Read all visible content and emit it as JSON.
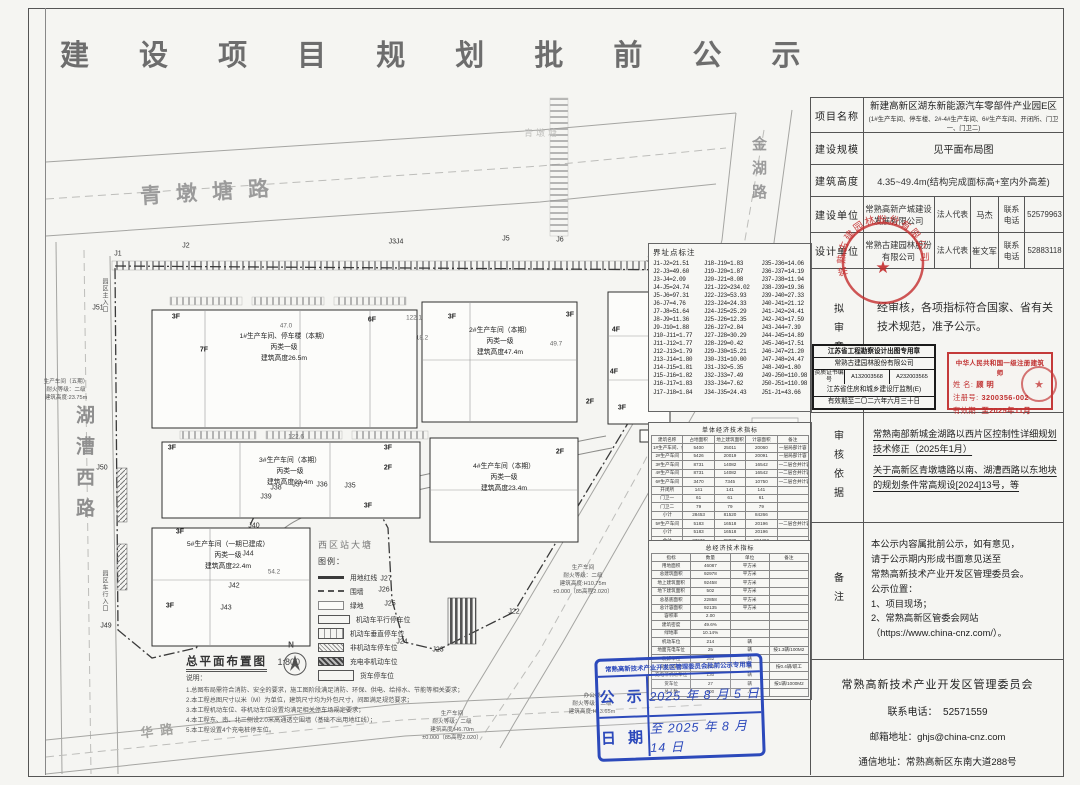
{
  "title": "建 设 项 目 规 划 批 前 公 示",
  "info": {
    "project_label": "项目名称",
    "project_name": "新建高新区湖东新能源汽车零部件产业园E区",
    "project_sub": "(1#生产车间、停车楼、2#-4#生产车间、6#生产车间、开闭所、门卫一、门卫二)",
    "scale_label": "建设规模",
    "scale_value": "见平面布局图",
    "height_label": "建筑高度",
    "height_value": "4.35~49.4m(结构完成面标高+室内外高差)",
    "builder_label": "建设单位",
    "builder_name": "常熟高新产城建设发展有限公司",
    "rep_label": "法人代表",
    "builder_rep": "马杰",
    "tel_label": "联系电话",
    "builder_tel": "52579963",
    "designer_label": "设计单位",
    "designer_name": "常熟古建园林股份有限公司",
    "designer_rep": "崔文军",
    "designer_tel": "52883118",
    "review_label": "拟审意见",
    "review_text": "经审核，各项指标符合国家、省有关技术规范，准予公示。",
    "basis_label": "审核依据",
    "basis_items": [
      "常熟南部新城金湖路以西片区控制性详细规划技术修正（2025年1月）",
      "关于高新区青墩塘路以南、湖漕西路以东地块的规划条件常高规设[2024]13号，等"
    ],
    "note_label": "备注",
    "note_lines": [
      "本公示内容属批前公示，如有意见，",
      "请于公示期内形成书面意见送至",
      "常熟高新技术产业开发区管理委员会。",
      "公示位置：",
      "1、项目现场；",
      "2、常熟高新区管委会网站",
      "（https://www.china-cnz.com/）。"
    ],
    "footer_org": "常熟高新技术产业开发区管理委员会",
    "footer_tel_label": "联系电话：",
    "footer_tel": "52571559",
    "footer_email_label": "邮箱地址：",
    "footer_email": "ghjs@china-cnz.com",
    "footer_addr_label": "通信地址：",
    "footer_addr": "常熟高新区东南大道288号"
  },
  "stamps": {
    "design_seal_text": "常熟古建园林股份有限公司",
    "design_seal_star": "★",
    "black_stamp": {
      "l1": "江苏省工程勘察设计出图专用章",
      "l2": "常熟古建园林股份有限公司",
      "cert_label": "资质证书编号",
      "cert1": "A132003568",
      "cert2": "A232003565",
      "l4": "江苏省住房和城乡建设厅监制(E)",
      "l5": "有效期至二〇二六年六月三十日"
    },
    "architect_stamp": {
      "title": "中华人民共和国一级注册建筑师",
      "name_label": "姓  名:",
      "name": "顾    明",
      "reg_label": "注册号:",
      "reg": "3200356-002",
      "valid_label": "有效期:",
      "valid": "至2025年11月",
      "seal_star": "★"
    },
    "blue_stamp": {
      "header": "常熟高新技术产业开发区管理委员会批前公示专用章",
      "row1_label": "公 示",
      "row1_value": "2025 年 8 月 5 日",
      "row2_label": "日 期",
      "row2_value": "至 2025 年 8 月 14 日"
    }
  },
  "map": {
    "roads": {
      "north": "青墩塘路",
      "east": "金湖路",
      "west": "湖漕西路",
      "south": "华路",
      "river": "青墩塘"
    },
    "entrance1": "园区主入口",
    "entrance2": "园区车行入口",
    "pond": "西区站大塘",
    "plan_title": "总平面布置图",
    "plan_scale": "1:800",
    "notes_title": "说明：",
    "notes": [
      "1.总图布局需符合消防、安全的要求，施工图阶段满足消防、环保、供电、给排水、节能等相关要求；",
      "2.本工程总图尺寸以米（M）为单位，建筑尺寸均为外包尺寸，间距满足规范要求；",
      "3.本工程机动车位、非机动车位设置均满足相关停车场规定要求；",
      "4.本工程东、南、北三侧设2.0米高通透空围墙（基础不出用地红线）；",
      "5.本工程设置4个充电桩停车位。"
    ],
    "buildings": {
      "b1": {
        "lines": [
          "1#生产车间、停车楼（本期）",
          "丙类一级",
          "建筑高度26.5m"
        ]
      },
      "b2": {
        "lines": [
          "2#生产车间（本期）",
          "丙类一级",
          "建筑高度47.4m"
        ]
      },
      "b3": {
        "lines": [
          "3#生产车间（本期）",
          "丙类一级",
          "建筑高度23.4m"
        ]
      },
      "b4": {
        "lines": [
          "4#生产车间（本期）",
          "丙类一级",
          "建筑高度23.4m"
        ]
      },
      "b5": {
        "lines": [
          "5#生产车间（一期已建成）",
          "丙类一级",
          "建筑高度22.4m"
        ]
      }
    },
    "context": {
      "c1": {
        "lines": [
          "生产车间（五期）",
          "耐火等级：二级",
          "建筑高度:23.75m"
        ]
      },
      "c2": {
        "lines": [
          "生产车间",
          "耐火等级：二级",
          "建筑高度:H10.75m",
          "±0.000（85高程2.020）"
        ]
      },
      "c3": {
        "lines": [
          "办公楼",
          "耐火等级：二级",
          "建筑高度:H13.65m"
        ]
      },
      "c4": {
        "lines": [
          "生产车间",
          "耐火等级：二级",
          "建筑高度:H6.70m",
          "±0.000（85高程2.020）"
        ]
      }
    },
    "floor_labels": [
      {
        "t": "3F",
        "x": 176,
        "y": 317
      },
      {
        "t": "7F",
        "x": 204,
        "y": 350
      },
      {
        "t": "6F",
        "x": 372,
        "y": 320
      },
      {
        "t": "3F",
        "x": 452,
        "y": 317
      },
      {
        "t": "3F",
        "x": 570,
        "y": 315
      },
      {
        "t": "4F",
        "x": 616,
        "y": 330
      },
      {
        "t": "4F",
        "x": 614,
        "y": 372
      },
      {
        "t": "3F",
        "x": 622,
        "y": 408
      },
      {
        "t": "2F",
        "x": 590,
        "y": 402
      },
      {
        "t": "3F",
        "x": 172,
        "y": 448
      },
      {
        "t": "3F",
        "x": 388,
        "y": 448
      },
      {
        "t": "2F",
        "x": 388,
        "y": 468
      },
      {
        "t": "3F",
        "x": 368,
        "y": 506
      },
      {
        "t": "2F",
        "x": 560,
        "y": 452
      },
      {
        "t": "3F",
        "x": 180,
        "y": 532
      },
      {
        "t": "3F",
        "x": 170,
        "y": 606
      },
      {
        "t": "2F",
        "x": 768,
        "y": 428
      },
      {
        "t": "3F",
        "x": 762,
        "y": 470
      }
    ],
    "j_labels": [
      {
        "t": "J1",
        "x": 118,
        "y": 254
      },
      {
        "t": "J2",
        "x": 186,
        "y": 246
      },
      {
        "t": "J3J4",
        "x": 396,
        "y": 242
      },
      {
        "t": "J5",
        "x": 506,
        "y": 239
      },
      {
        "t": "J6",
        "x": 560,
        "y": 240
      },
      {
        "t": "J17",
        "x": 652,
        "y": 260
      },
      {
        "t": "J20",
        "x": 686,
        "y": 264
      },
      {
        "t": "J21",
        "x": 710,
        "y": 282
      },
      {
        "t": "J22",
        "x": 514,
        "y": 612
      },
      {
        "t": "J23",
        "x": 438,
        "y": 650
      },
      {
        "t": "J24",
        "x": 402,
        "y": 642
      },
      {
        "t": "J25",
        "x": 390,
        "y": 604
      },
      {
        "t": "J26",
        "x": 384,
        "y": 590
      },
      {
        "t": "J27",
        "x": 386,
        "y": 579
      },
      {
        "t": "J35",
        "x": 350,
        "y": 486
      },
      {
        "t": "J36",
        "x": 322,
        "y": 485
      },
      {
        "t": "J37",
        "x": 298,
        "y": 485
      },
      {
        "t": "J38",
        "x": 276,
        "y": 488
      },
      {
        "t": "J39",
        "x": 266,
        "y": 497
      },
      {
        "t": "J40",
        "x": 254,
        "y": 526
      },
      {
        "t": "J42",
        "x": 234,
        "y": 586
      },
      {
        "t": "J43",
        "x": 226,
        "y": 608
      },
      {
        "t": "J44",
        "x": 248,
        "y": 554
      },
      {
        "t": "J49",
        "x": 106,
        "y": 626
      },
      {
        "t": "J50",
        "x": 102,
        "y": 468
      },
      {
        "t": "J51",
        "x": 98,
        "y": 308
      }
    ],
    "dim_labels": [
      {
        "t": "47.0",
        "x": 286,
        "y": 326
      },
      {
        "t": "122.1",
        "x": 414,
        "y": 318
      },
      {
        "t": "18.2",
        "x": 422,
        "y": 338
      },
      {
        "t": "49.7",
        "x": 556,
        "y": 344
      },
      {
        "t": "122.6",
        "x": 296,
        "y": 437
      },
      {
        "t": "54.2",
        "x": 274,
        "y": 572
      }
    ],
    "misc_labels": [
      {
        "t": "N",
        "x": 291,
        "y": 645
      }
    ],
    "legend": {
      "title": "图例：",
      "items": [
        "用地红线",
        "围墙",
        "绿地",
        "机动车平行停车位",
        "机动车垂直停车位",
        "非机动车停车位",
        "充电非机动车位",
        "货车停车位"
      ]
    },
    "boundary": {
      "title": "界址点标注",
      "col1": [
        "J1-J2=21.51",
        "J2-J3=49.60",
        "J3-J4=2.09",
        "J4-J5=24.74",
        "J5-J6=97.31",
        "J6-J7=4.76",
        "J7-J8=51.64",
        "J8-J9=11.36",
        "J9-J10=1.88",
        "J10-J11=1.77",
        "J11-J12=1.77",
        "J12-J13=1.79",
        "J13-J14=1.80",
        "J14-J15=1.81",
        "J15-J16=1.82",
        "J16-J17=1.83",
        "J17-J18=1.84"
      ],
      "col2": [
        "J18-J19=1.83",
        "J19-J20=1.87",
        "J20-J21=8.08",
        "J21-J22=234.02",
        "J22-J23=53.93",
        "J23-J24=24.33",
        "J24-J25=25.29",
        "J25-J26=12.35",
        "J26-J27=2.84",
        "J27-J28=30.29",
        "J28-J29=0.42",
        "J29-J30=15.21",
        "J30-J31=10.00",
        "J31-J32=5.35",
        "J32-J33=7.49",
        "J33-J34=7.62",
        "J34-J35=24.43"
      ],
      "col3": [
        "J35-J36=14.06",
        "J36-J37=14.19",
        "J37-J38=11.94",
        "J38-J39=19.36",
        "J39-J40=27.33",
        "J40-J41=21.12",
        "J41-J42=24.41",
        "J42-J43=17.59",
        "J43-J44=7.39",
        "J44-J45=14.89",
        "J45-J46=17.51",
        "J46-J47=21.20",
        "J47-J48=24.47",
        "J48-J49=1.80",
        "J49-J50=110.98",
        "J50-J51=110.98",
        "J51-J1=43.66"
      ]
    },
    "unit_table": {
      "title": "单体经济技术指标",
      "headers": [
        "建筑名称",
        "占地面积",
        "地上建筑面积",
        "计容面积",
        "备注"
      ],
      "rows": [
        [
          "1#生产车间、停车楼",
          "5400",
          "25011",
          "20060",
          "一层局部计容"
        ],
        [
          "2#生产车间",
          "5426",
          "20019",
          "20091",
          "一层局部计容"
        ],
        [
          "3#生产车间",
          "8731",
          "14082",
          "16542",
          "一二层合并计容"
        ],
        [
          "4#生产车间",
          "8731",
          "14082",
          "16542",
          "一二层合并计容"
        ],
        [
          "6#生产车间",
          "3470",
          "7345",
          "10750",
          "一二层合并计容"
        ],
        [
          "开闭所",
          "141",
          "141",
          "141",
          ""
        ],
        [
          "门卫一",
          "61",
          "61",
          "61",
          ""
        ],
        [
          "门卫二",
          "79",
          "79",
          "79",
          ""
        ],
        [
          "小计",
          "28453",
          "81520",
          "84266",
          ""
        ],
        [
          "5#生产车间",
          "5183",
          "16518",
          "20196",
          "一二层合并计容"
        ],
        [
          "小计",
          "5183",
          "16518",
          "20196",
          ""
        ],
        [
          "合计",
          "33636",
          "98038",
          "104462",
          ""
        ]
      ]
    },
    "total_table": {
      "title": "总经济技术指标",
      "headers": [
        "指标",
        "数量",
        "单位",
        "备注"
      ],
      "rows": [
        [
          "用地面积",
          "46087",
          "平方米",
          ""
        ],
        [
          "总建筑面积",
          "92978",
          "平方米",
          ""
        ],
        [
          "地上建筑面积",
          "92458",
          "平方米",
          ""
        ],
        [
          "地下建筑面积",
          "502",
          "平方米",
          ""
        ],
        [
          "总基底面积",
          "22858",
          "平方米",
          ""
        ],
        [
          "总计容面积",
          "92135",
          "平方米",
          ""
        ],
        [
          "容积率",
          "2.00",
          "",
          ""
        ],
        [
          "建筑密度",
          "49.6%",
          "",
          ""
        ],
        [
          "绿地率",
          "10.14%",
          "",
          ""
        ],
        [
          "机动车位",
          "214",
          "辆",
          ""
        ],
        [
          "地面充电车位",
          "25",
          "辆",
          "按1.3辆/100M2"
        ],
        [
          "装卸车位",
          "252",
          "辆",
          ""
        ],
        [
          "非机动车位",
          "252",
          "辆",
          "按0.4辆/职工"
        ],
        [
          "充电非机动车位",
          "130",
          "辆",
          ""
        ],
        [
          "货车位",
          "27",
          "辆",
          "按1辆/1000M2"
        ],
        [
          "总人数",
          "900",
          "人",
          ""
        ]
      ]
    }
  }
}
